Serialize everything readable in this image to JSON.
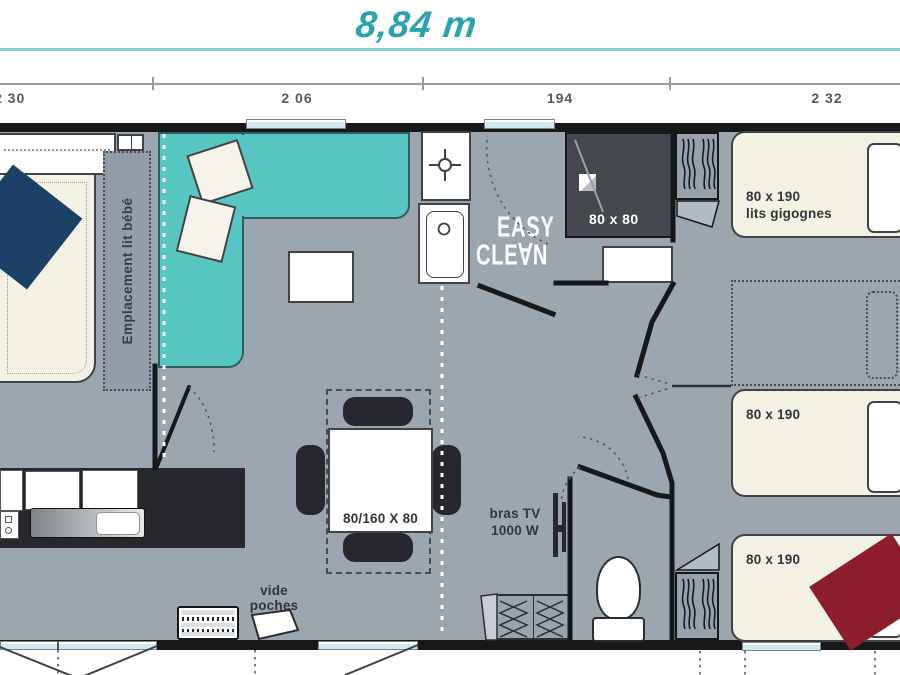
{
  "header": {
    "total_length": "8,84 m",
    "dims": [
      "2 30",
      "2 06",
      "194",
      "2 32"
    ]
  },
  "labels": {
    "baby_bed_zone": "Emplacement lit bébé",
    "shower_size": "80 x 80",
    "easy_clean": [
      "EASY",
      "CLE∀N"
    ],
    "bunk_bed_size": "80 x 190",
    "bunk_bed_type": "lits gigognes",
    "bed2_size": "80 x 190",
    "bed3_size": "80 x 190",
    "table_size": "80/160 X 80",
    "tv": [
      "bras TV",
      "1000 W"
    ],
    "pockets": [
      "vide",
      "poches"
    ]
  },
  "colors": {
    "accent_teal": "#2ba3ac",
    "rule_teal": "#8ccfd3",
    "sofa_teal": "#57c6c1",
    "floor_gray": "#9ca6af",
    "wall_black": "#17181a",
    "bed_cream": "#f3f0e4",
    "navy_blanket": "#1d4166",
    "burgundy_blanket": "#8d1c2d",
    "shower_dark": "#44474c",
    "window_glass": "#cfe9f3",
    "counter_dark": "#26282b"
  }
}
